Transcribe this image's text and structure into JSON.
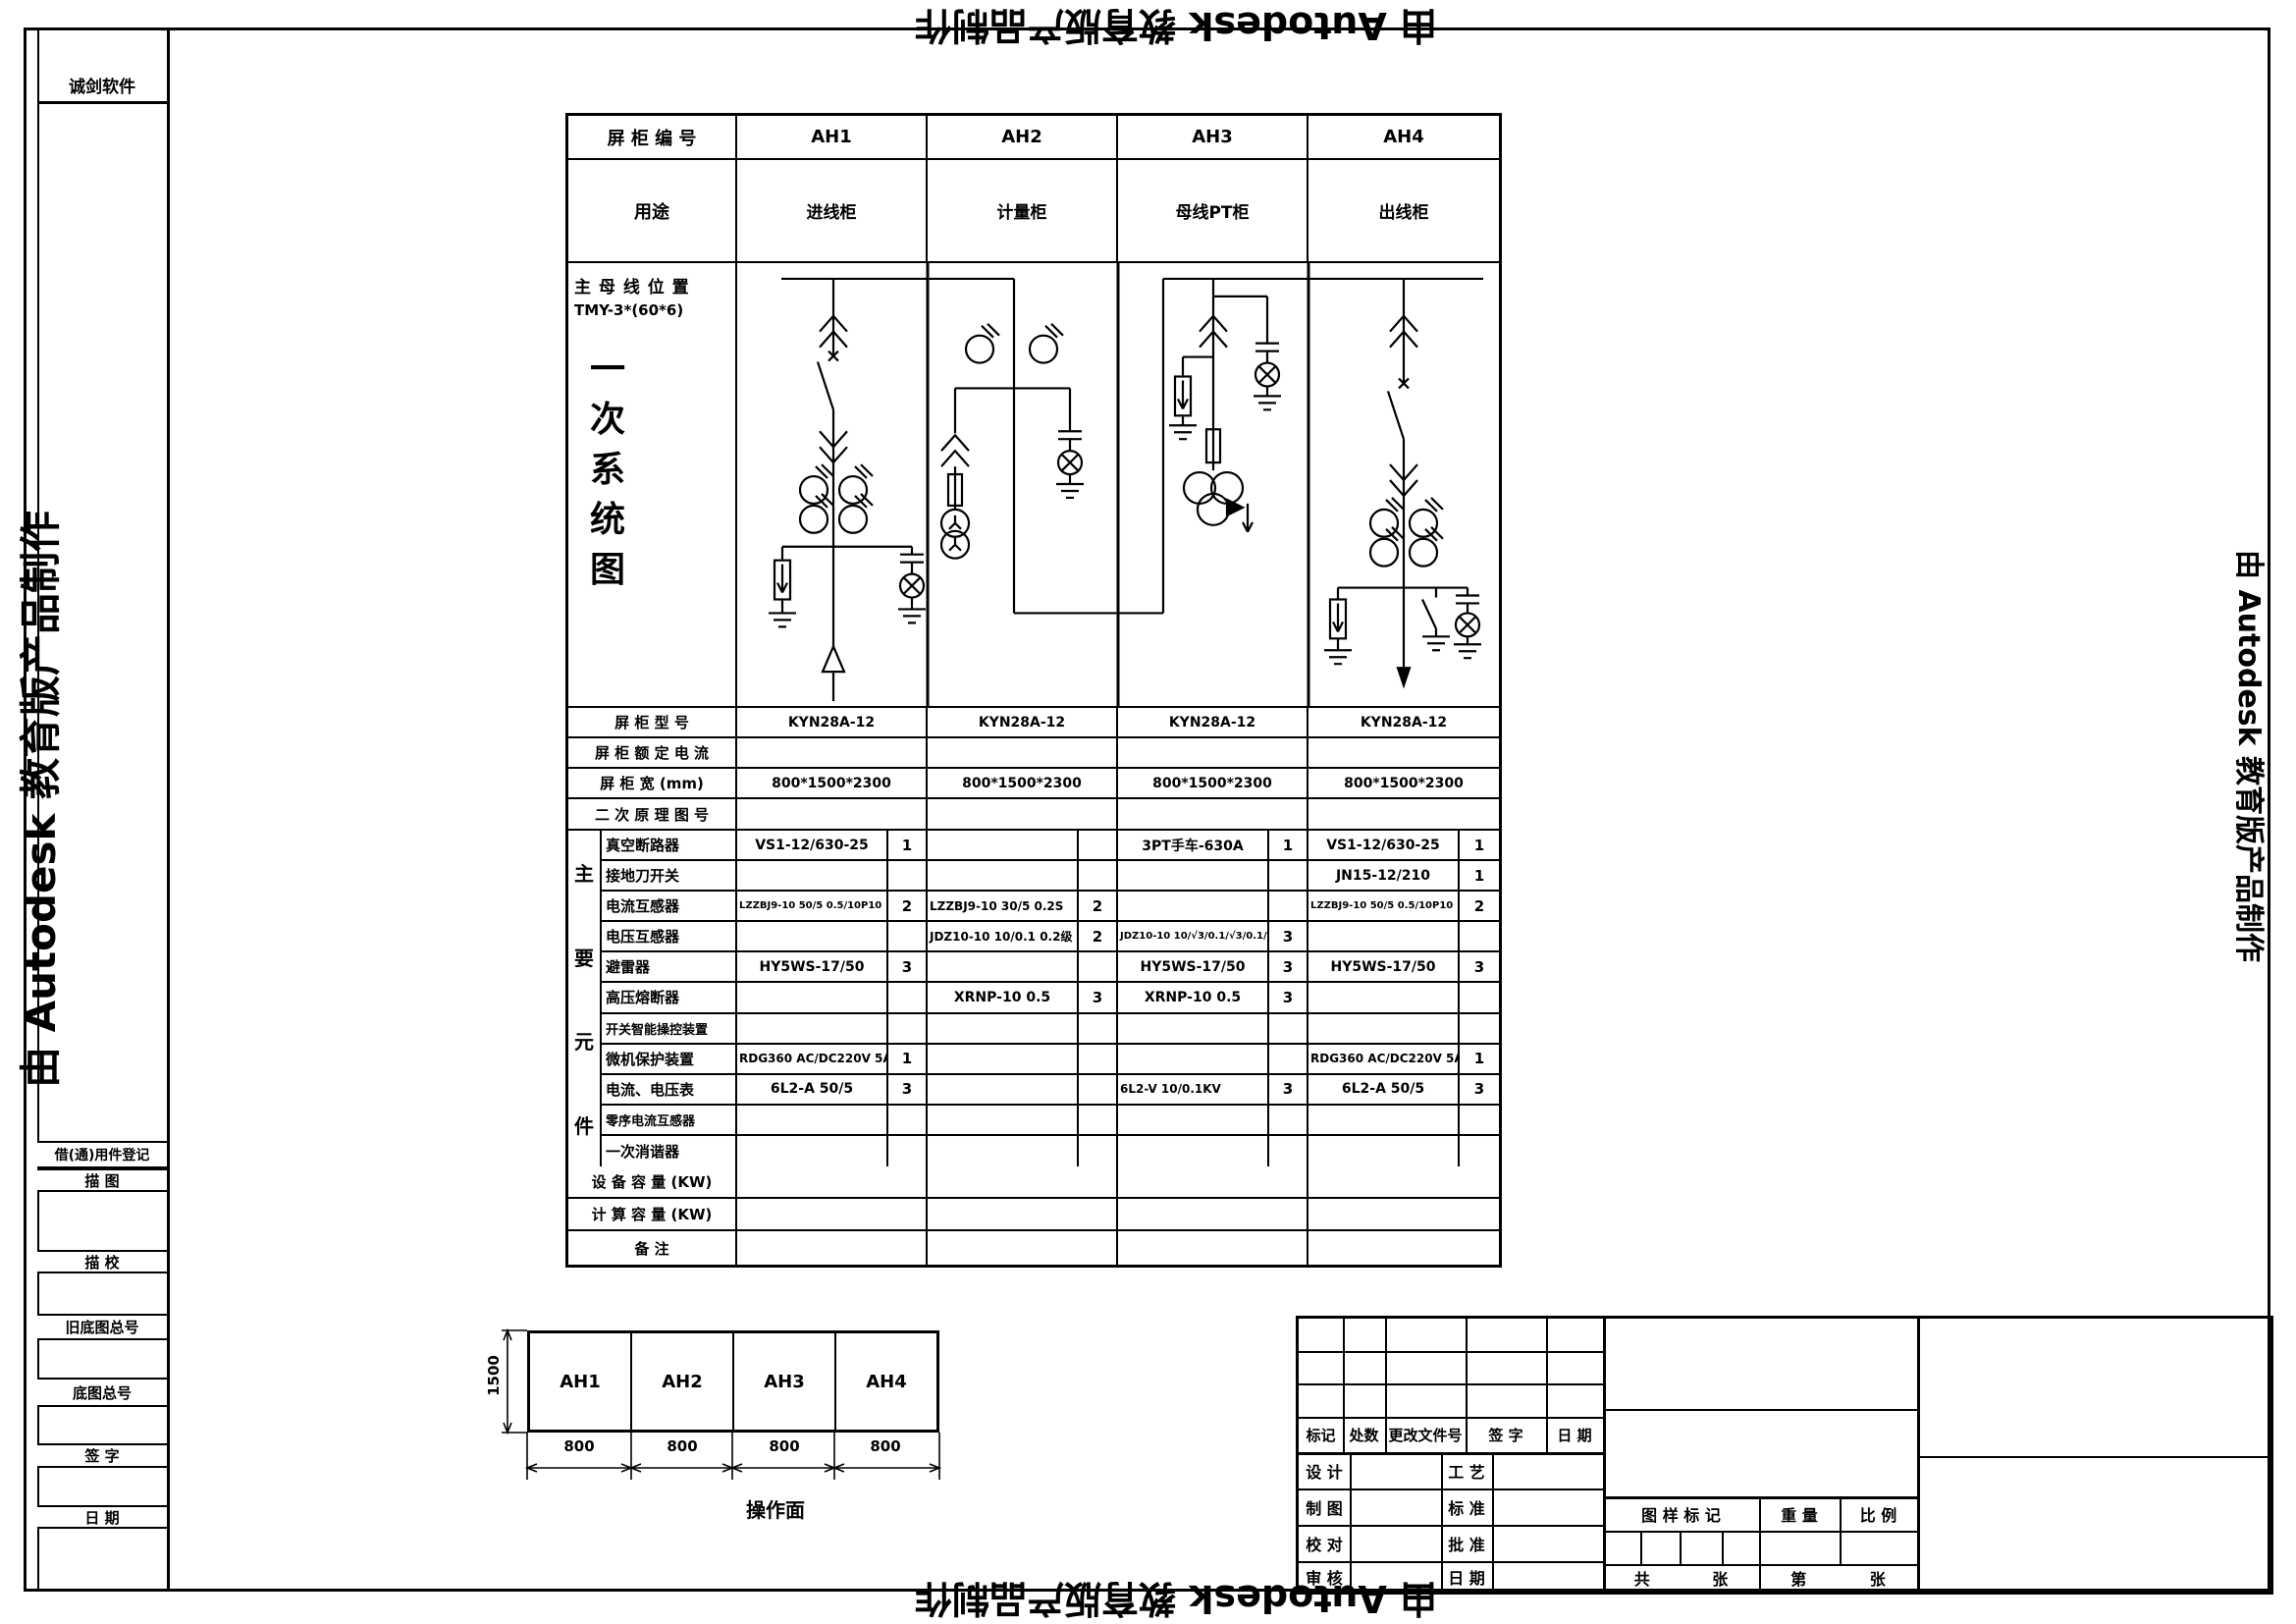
{
  "watermark": {
    "autodesk_text": "由 Autodesk 教育版产品制作",
    "vendor_text": "诚剑软件"
  },
  "sidebar": {
    "row_labels": [
      "借(通)用件登记",
      "描  图",
      "描  校",
      "旧底图总号",
      "底图总号",
      "签  字",
      "日  期"
    ]
  },
  "schedule": {
    "panel_no_label": "屏 柜 编 号",
    "panels": [
      "AH1",
      "AH2",
      "AH3",
      "AH4"
    ],
    "purpose_label": "用途",
    "purposes": [
      "进线柜",
      "计量柜",
      "母线PT柜",
      "出线柜"
    ],
    "busbar_label": "主 母 线 位 置",
    "busbar_spec": "TMY-3*(60*6)",
    "diagram_title_chars": [
      "一",
      "次",
      "系",
      "统",
      "图"
    ],
    "model_label": "屏 柜 型 号",
    "models": [
      "KYN28A-12",
      "KYN28A-12",
      "KYN28A-12",
      "KYN28A-12"
    ],
    "rated_current_label": "屏 柜 额 定 电 流",
    "size_label": "屏 柜 宽 (mm)",
    "sizes": [
      "800*1500*2300",
      "800*1500*2300",
      "800*1500*2300",
      "800*1500*2300"
    ],
    "secondary_label": "二 次 原 理 图 号",
    "group_label_chars": [
      "主",
      "要",
      "元",
      "件"
    ],
    "component_rows": [
      {
        "label": "真空断路器",
        "cells": [
          [
            "VS1-12/630-25",
            "1"
          ],
          [
            "",
            ""
          ],
          [
            "3PT手车-630A",
            "1"
          ],
          [
            "VS1-12/630-25",
            "1"
          ]
        ]
      },
      {
        "label": "接地刀开关",
        "cells": [
          [
            "",
            ""
          ],
          [
            "",
            ""
          ],
          [
            "",
            ""
          ],
          [
            "JN15-12/210",
            "1"
          ]
        ]
      },
      {
        "label": "电流互感器",
        "cells": [
          [
            "LZZBJ9-10 50/5 0.5/10P10",
            "2"
          ],
          [
            "LZZBJ9-10 30/5 0.2S",
            "2"
          ],
          [
            "",
            ""
          ],
          [
            "LZZBJ9-10 50/5 0.5/10P10",
            "2"
          ]
        ]
      },
      {
        "label": "电压互感器",
        "cells": [
          [
            "",
            ""
          ],
          [
            "JDZ10-10 10/0.1 0.2级",
            "2"
          ],
          [
            "JDZ10-10 10/√3/0.1/√3/0.1/3kV",
            "3"
          ],
          [
            "",
            ""
          ]
        ]
      },
      {
        "label": "避雷器",
        "cells": [
          [
            "HY5WS-17/50",
            "3"
          ],
          [
            "",
            ""
          ],
          [
            "HY5WS-17/50",
            "3"
          ],
          [
            "HY5WS-17/50",
            "3"
          ]
        ]
      },
      {
        "label": "高压熔断器",
        "cells": [
          [
            "",
            ""
          ],
          [
            "XRNP-10 0.5",
            "3"
          ],
          [
            "XRNP-10 0.5",
            "3"
          ],
          [
            "",
            ""
          ]
        ]
      },
      {
        "label": "开关智能操控装置",
        "cells": [
          [
            "",
            ""
          ],
          [
            "",
            ""
          ],
          [
            "",
            ""
          ],
          [
            "",
            ""
          ]
        ]
      },
      {
        "label": "微机保护装置",
        "cells": [
          [
            "RDG360 AC/DC220V 5A",
            "1"
          ],
          [
            "",
            ""
          ],
          [
            "",
            ""
          ],
          [
            "RDG360 AC/DC220V 5A",
            "1"
          ]
        ]
      },
      {
        "label": "电流、电压表",
        "cells": [
          [
            "6L2-A 50/5",
            "3"
          ],
          [
            "",
            ""
          ],
          [
            "6L2-V 10/0.1KV",
            "3"
          ],
          [
            "6L2-A 50/5",
            "3"
          ]
        ]
      },
      {
        "label": "零序电流互感器",
        "cells": [
          [
            "",
            ""
          ],
          [
            "",
            ""
          ],
          [
            "",
            ""
          ],
          [
            "",
            ""
          ]
        ]
      },
      {
        "label": "一次消谐器",
        "cells": [
          [
            "",
            ""
          ],
          [
            "",
            ""
          ],
          [
            "",
            ""
          ],
          [
            "",
            ""
          ]
        ]
      }
    ],
    "device_capacity_label": "设 备 容 量 (KW)",
    "calc_capacity_label": "计 算 容 量 (KW)",
    "remark_label": "备 注"
  },
  "front_view": {
    "height_dim": "1500",
    "cabinets": [
      "AH1",
      "AH2",
      "AH3",
      "AH4"
    ],
    "width_dims": [
      "800",
      "800",
      "800",
      "800"
    ],
    "caption": "操作面"
  },
  "title_block": {
    "rev_headers": [
      "标记",
      "处数",
      "更改文件号",
      "签 字",
      "日 期"
    ],
    "sign_rows": [
      {
        "l1": "设 计",
        "l2": "工 艺"
      },
      {
        "l1": "制 图",
        "l2": "标 准"
      },
      {
        "l1": "校 对",
        "l2": "批 准"
      },
      {
        "l1": "审 核",
        "l2": "日 期"
      }
    ],
    "stamp_label": "图 样 标 记",
    "weight_label": "重 量",
    "scale_label": "比 例",
    "sheets_total_prefix": "共",
    "sheets_total_suffix": "张",
    "sheet_no_prefix": "第",
    "sheet_no_suffix": "张"
  }
}
